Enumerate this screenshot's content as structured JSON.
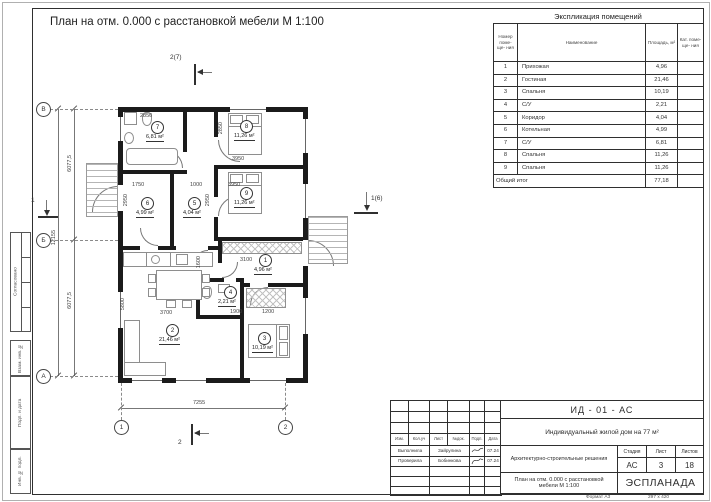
{
  "sheet": {
    "title": "План на отм. 0.000 с расстановкой мебели М 1:100",
    "format_label": "Формат А3",
    "format_size": "297 x 420"
  },
  "explication": {
    "title": "Экспликация помещений",
    "headers": {
      "num": "Номер поме- ще- ния",
      "name": "Наименование",
      "area": "Площадь, м²",
      "cat": "Кат. поме- ще- ния"
    },
    "rows": [
      {
        "num": "1",
        "name": "Прихожая",
        "area": "4,96",
        "cat": ""
      },
      {
        "num": "2",
        "name": "Гостиная",
        "area": "21,46",
        "cat": ""
      },
      {
        "num": "3",
        "name": "Спальня",
        "area": "10,19",
        "cat": ""
      },
      {
        "num": "4",
        "name": "С/У",
        "area": "2,21",
        "cat": ""
      },
      {
        "num": "5",
        "name": "Коридор",
        "area": "4,04",
        "cat": ""
      },
      {
        "num": "6",
        "name": "Котельная",
        "area": "4,99",
        "cat": ""
      },
      {
        "num": "7",
        "name": "С/У",
        "area": "6,81",
        "cat": ""
      },
      {
        "num": "8",
        "name": "Спальня",
        "area": "11,26",
        "cat": ""
      },
      {
        "num": "9",
        "name": "Спальня",
        "area": "11,26",
        "cat": ""
      }
    ],
    "total_label": "Общий итог",
    "total_area": "77,18"
  },
  "plan": {
    "rooms": [
      {
        "num": "1",
        "area": "4,96 м²"
      },
      {
        "num": "2",
        "area": "21,46 м²"
      },
      {
        "num": "3",
        "area": "10,19 м²"
      },
      {
        "num": "4",
        "area": "2,21 м²"
      },
      {
        "num": "5",
        "area": "4,04 м²"
      },
      {
        "num": "6",
        "area": "4,99 м²"
      },
      {
        "num": "7",
        "area": "6,81 м²"
      },
      {
        "num": "8",
        "area": "11,26 м²"
      },
      {
        "num": "9",
        "area": "11,26 м²"
      }
    ],
    "dims": {
      "overall_width": "7255",
      "height_upper": "6077,5",
      "height_lower": "6077,5",
      "height_total": "12155",
      "d2850_top": "2850",
      "d2850_v": "2850",
      "d3950_r8": "3950",
      "d3950_r9": "3950",
      "d2950_l": "2950",
      "d2950_r": "2950",
      "d1750": "1750",
      "d1000": "1000",
      "d3100": "3100",
      "d1900": "1900",
      "d1200": "1200",
      "d3700": "3700",
      "d5800": "5800",
      "d1600": "1600"
    },
    "grid": {
      "row_b": "В",
      "row_mid": "Б",
      "row_a": "А",
      "col_1": "1",
      "col_2": "2"
    },
    "markers": {
      "top": "2(7)",
      "right": "1(6)",
      "left": "1",
      "bottom": "2"
    }
  },
  "titleblock": {
    "doc_code": "ИД - 01 - АС",
    "object_name": "Индивидуальный жилой дом на 77 м²",
    "doc_type": "Архитектурно-строительные решения",
    "drawing_name": "План на отм. 0.000 с расстановкой мебели М 1:100",
    "stage_label": "Стадия",
    "sheet_label": "Лист",
    "sheets_label": "Листов",
    "stage": "АС",
    "sheet_no": "3",
    "sheets_total": "18",
    "logo": "ЭСПЛАНАДА",
    "columns": [
      "Изм.",
      "Кол.уч",
      "Лист",
      "№док.",
      "Подп.",
      "Дата"
    ],
    "signatures": [
      {
        "role": "Выполнила",
        "name": "Зайрулина",
        "date": "07.24"
      },
      {
        "role": "Проверила",
        "name": "Бобинкова",
        "date": "07.24"
      }
    ]
  },
  "margin": {
    "items": [
      "Согласовано",
      "Взам. инв. №",
      "Подп. и дата",
      "Инв. № подл."
    ]
  }
}
